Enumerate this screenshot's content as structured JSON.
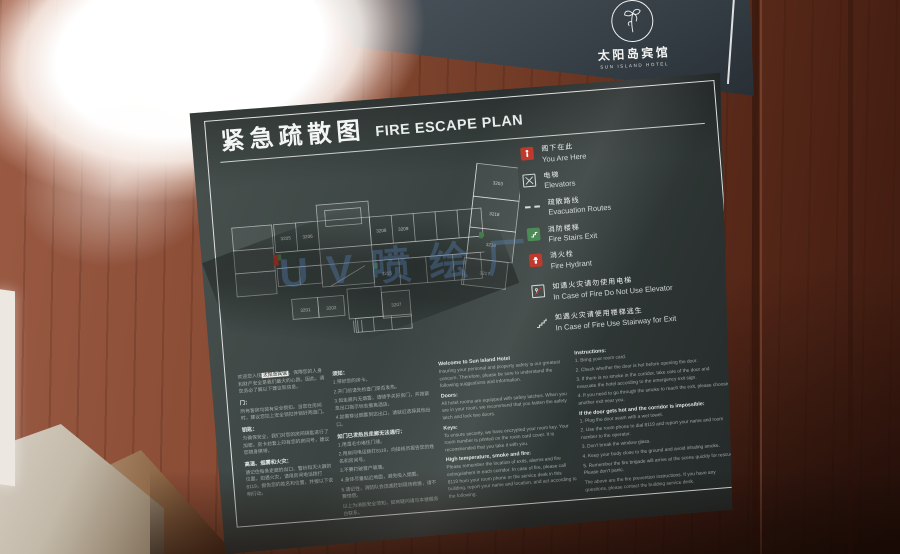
{
  "watermark": "UV喷绘厂",
  "logo_panel": {
    "hotel_zh": "太阳岛宾馆",
    "hotel_en": "SUN ISLAND HOTEL"
  },
  "sign": {
    "title_zh": "紧急疏散图",
    "title_en": "FIRE ESCAPE PLAN",
    "legend": [
      {
        "zh": "阁下在此",
        "en": "You Are Here"
      },
      {
        "zh": "电梯",
        "en": "Elevators"
      },
      {
        "zh": "疏散路线",
        "en": "Evacuation Routes"
      },
      {
        "zh": "消防楼梯",
        "en": "Fire Stairs Exit"
      },
      {
        "zh": "消火栓",
        "en": "Fire Hydrant"
      },
      {
        "zh": "如遇火灾请勿使用电梯",
        "en": "In Case of Fire Do Not Use Elevator"
      },
      {
        "zh": "如遇火灾请使用楼梯逃生",
        "en": "In Case of Fire Use Stairway for Exit"
      }
    ],
    "rooms": [
      "3203",
      "3218",
      "3216",
      "3217",
      "3205",
      "3206",
      "3208",
      "3209",
      "3215",
      "3201",
      "3202",
      "3207"
    ],
    "text": {
      "cn1": {
        "intro_pre": "欢迎您入住",
        "hotel": "太阳岛宾馆",
        "intro_post": "，保障您的人身和财产安全是我们最大的心愿。因此，请您务必了解以下建议和信息。",
        "doors_h": "门：",
        "doors_p": "所有客房均装有安全锁扣。当您在房间时，建议您扣上安全锁扣并锁好两道门。",
        "keys_h": "钥匙：",
        "keys_p": "为确保安全，我们对您的房间钥匙进行了加密。房卡封套上印有您的房间号，建议您随身携带。",
        "fire_h": "高温、烟雾和火灾：",
        "fire_p": "请记住每条走廊的出口、警铃和灭火器的位置。如遇火灾，请用房间电话拨打8119，报告您的姓名和位置，并按以下说明行动。"
      },
      "cn2": {
        "h": "须知：",
        "l1": "1.带好您的房卡。",
        "l2": "2.开门前请先检查门是否发热。",
        "l3": "3.如走廊内无烟雾，请随手关好房门，并按紧急出口指示标志撤离酒店。",
        "l4": "4.如需穿过烟雾到达出口，请就近选择其他出口。",
        "sub": "如门已发热且走廊无法通行：",
        "m1": "1.用湿毛巾堵住门缝。",
        "m2": "2.用房间电话拨打8119，向接线员报告您的姓名和房间号。",
        "m3": "3.不要打破窗户玻璃。",
        "m4": "4.身体尽量贴近地面，避免吸入烟雾。",
        "m5": "5.请记住，消防队会迅速赶到现场救援，请不要惊慌。",
        "footer": "以上为消防安全须知，如有疑问请与本楼服务台联系。"
      },
      "en1": {
        "welcome_h": "Welcome to Sun Island Hotel",
        "welcome_p": "Insuring your personal and property safety is our greatest concern. Therefore, please be sure to understand the following suggestions and information.",
        "doors_h": "Doors:",
        "doors_p": "All hotel rooms are equipped with safety latches. When you are in your room, we recommend that you fasten the safety latch and lock two doors.",
        "keys_h": "Keys:",
        "keys_p": "To ensure security, we have encrypted your room key. Your room number is printed on the room card cover. It is recommended that you take it with you.",
        "fire_h": "High temperature, smoke and fire:",
        "fire_p": "Please remember the location of exits, alarms and fire extinguishers in each corridor. In case of fire, please call 8119 from your room phone or the service desk in this building, report your name and location, and act according to the following."
      },
      "en2": {
        "h": "Instructions:",
        "l1": "1. Bring your room card.",
        "l2": "2. Check whether the door is hot before opening the door.",
        "l3": "3. If there is no smoke in the corridor, take care of the door and evacuate the hotel according to the emergency exit sign.",
        "l4": "4. If you need to go through the smoke to reach the exit, please choose another exit near you.",
        "sub": "If the door gets hot and the corridor is impossible:",
        "m1": "1. Plug the door seam with a wet towel.",
        "m2": "2. Use the room phone to dial 8119 and report your name and room number to the operator.",
        "m3": "3. Don't break the window glass.",
        "m4": "4. Keep your body close to the ground and avoid inhaling smoke.",
        "m5": "5. Remember the fire brigade will arrive at the scene quickly for rescue. Please don't panic.",
        "footer": "The above are the fire prevention instructions. If you have any questions, please contact the building service desk."
      }
    }
  },
  "colors": {
    "accent_red": "#bf3a2d",
    "accent_green": "#4c8a56",
    "sign_bg": "#3a4442",
    "watermark_blue": "#6096d6",
    "wood": "#743d28"
  }
}
